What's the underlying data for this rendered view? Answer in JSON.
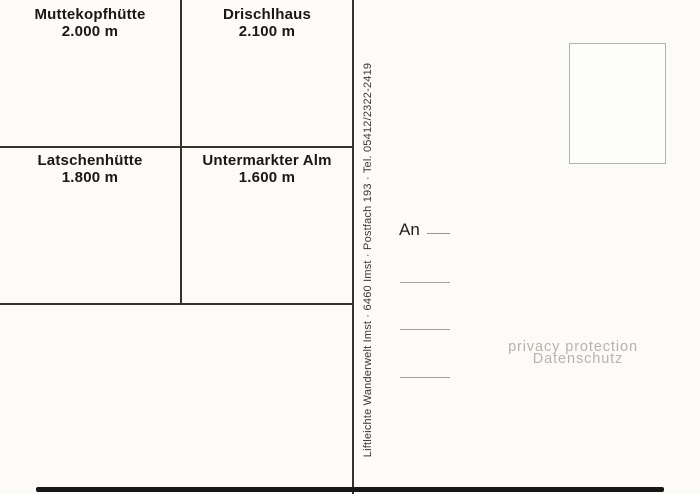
{
  "card": {
    "grid": {
      "cells": [
        {
          "name": "Muttekopfhütte",
          "elevation": "2.000 m"
        },
        {
          "name": "Drischlhaus",
          "elevation": "2.100 m"
        },
        {
          "name": "Latschenhütte",
          "elevation": "1.800 m"
        },
        {
          "name": "Untermarkter Alm",
          "elevation": "1.600 m"
        }
      ]
    },
    "publisher_imprint": "Liftleichte Wanderwelt Imst · 6460 Imst · Postfach 193 · Tel. 05412/2322-2419",
    "address": {
      "label": "An"
    },
    "watermark": {
      "line1": "privacy protection",
      "line2": "Datenschutz",
      "color": "#b7b3ac"
    },
    "colors": {
      "background": "#fcfbf8",
      "line": "#35312b",
      "text": "#1b1813"
    }
  }
}
